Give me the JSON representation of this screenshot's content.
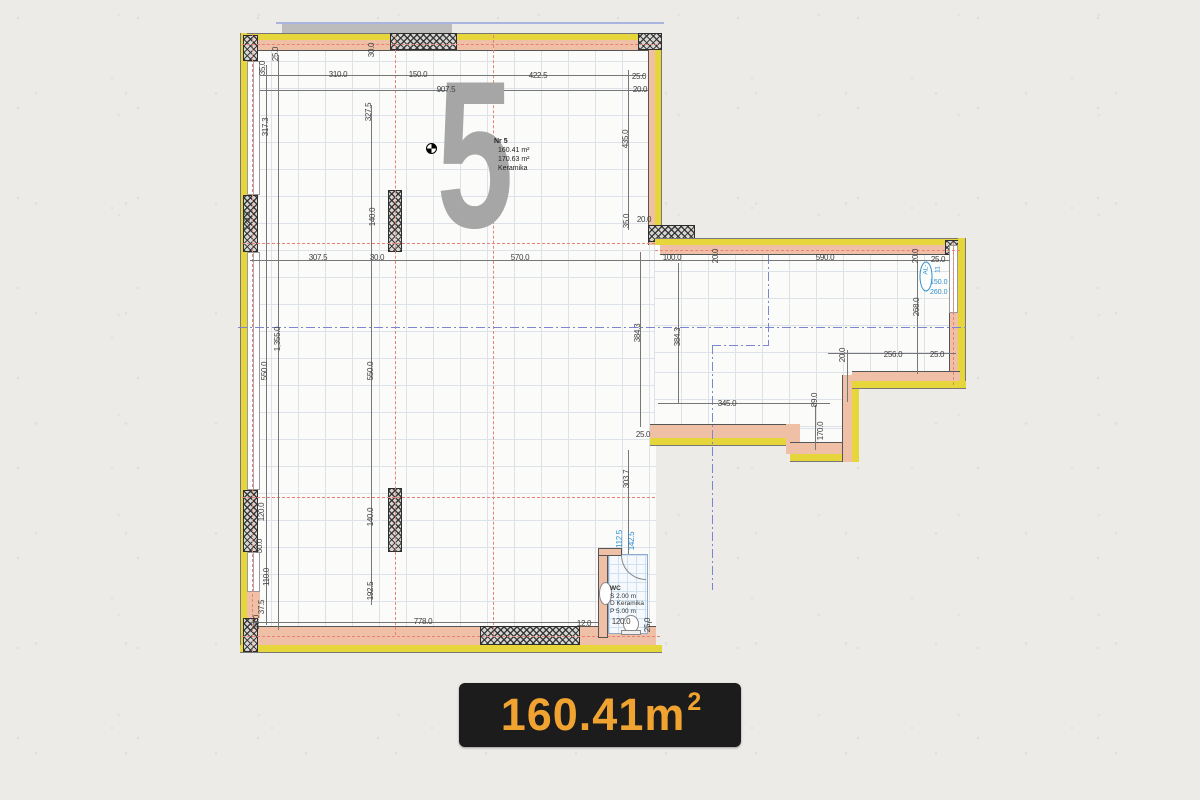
{
  "badge": {
    "value": "160.41m",
    "sup": "2"
  },
  "watermark": {
    "digit": "5"
  },
  "unit_info": {
    "line1": "Nr 5",
    "line2": "160.41 m²",
    "line3": "170.63 m²",
    "line4": "Keramika"
  },
  "wc": {
    "title": "WC",
    "line1": "S 2.00 m",
    "line2": "D Keramika",
    "line3": "P 5.00 m"
  },
  "window_tag": {
    "label": "AL-11",
    "width": "150.0",
    "height": "260.0"
  },
  "colors": {
    "paper": "#edebe8",
    "wall_yellow": "#e7d63b",
    "wall_fill": "#efc0a6",
    "axis_red": "#e88276",
    "axis_blue": "#7b85d2",
    "grid": "#dde2e8",
    "badge_bg": "#1c1c1c",
    "badge_text": "#f0a330",
    "dim_text": "#3f3f3f",
    "watermark": "#a6a6a6",
    "tag_blue": "#2f8fd0"
  },
  "dimensions": [
    {
      "t": "310.0",
      "x": 108,
      "y": 55
    },
    {
      "t": "150.0",
      "x": 188,
      "y": 55
    },
    {
      "t": "422.5",
      "x": 308,
      "y": 56
    },
    {
      "t": "25.0",
      "x": 409,
      "y": 57
    },
    {
      "t": "907.5",
      "x": 216,
      "y": 70
    },
    {
      "t": "20.0",
      "x": 410,
      "y": 70
    },
    {
      "t": "35.0",
      "x": 33,
      "y": 48,
      "r": 1
    },
    {
      "t": "25.0",
      "x": 46,
      "y": 34,
      "r": 1
    },
    {
      "t": "30.0",
      "x": 142,
      "y": 30,
      "r": 1
    },
    {
      "t": "317.3",
      "x": 36,
      "y": 107,
      "r": 1
    },
    {
      "t": "327.5",
      "x": 139,
      "y": 92,
      "r": 1
    },
    {
      "t": "435.0",
      "x": 396,
      "y": 119,
      "r": 1
    },
    {
      "t": "120.3",
      "x": 18,
      "y": 201,
      "r": 1
    },
    {
      "t": "140.0",
      "x": 143,
      "y": 197,
      "r": 1
    },
    {
      "t": "35.0",
      "x": 397,
      "y": 201,
      "r": 1
    },
    {
      "t": "20.0",
      "x": 414,
      "y": 200
    },
    {
      "t": "307.5",
      "x": 88,
      "y": 238
    },
    {
      "t": "30.0",
      "x": 147,
      "y": 238
    },
    {
      "t": "570.0",
      "x": 290,
      "y": 238
    },
    {
      "t": "100.0",
      "x": 442,
      "y": 238
    },
    {
      "t": "20.0",
      "x": 486,
      "y": 236,
      "r": 1
    },
    {
      "t": "590.0",
      "x": 595,
      "y": 238
    },
    {
      "t": "20.0",
      "x": 686,
      "y": 236,
      "r": 1
    },
    {
      "t": "25.0",
      "x": 708,
      "y": 240
    },
    {
      "t": "550.0",
      "x": 35,
      "y": 351,
      "r": 1
    },
    {
      "t": "1,355.0",
      "x": 48,
      "y": 319,
      "r": 1
    },
    {
      "t": "550.0",
      "x": 141,
      "y": 351,
      "r": 1
    },
    {
      "t": "384.3",
      "x": 408,
      "y": 313,
      "r": 1
    },
    {
      "t": "384.3",
      "x": 448,
      "y": 317,
      "r": 1
    },
    {
      "t": "268.0",
      "x": 687,
      "y": 287,
      "r": 1
    },
    {
      "t": "345.0",
      "x": 497,
      "y": 384
    },
    {
      "t": "89.0",
      "x": 585,
      "y": 380,
      "r": 1
    },
    {
      "t": "170.0",
      "x": 591,
      "y": 411,
      "r": 1
    },
    {
      "t": "20.0",
      "x": 613,
      "y": 335,
      "r": 1
    },
    {
      "t": "256.0",
      "x": 663,
      "y": 335
    },
    {
      "t": "25.0",
      "x": 707,
      "y": 335
    },
    {
      "t": "25.0",
      "x": 413,
      "y": 415
    },
    {
      "t": "120.0",
      "x": 32,
      "y": 492,
      "r": 1
    },
    {
      "t": "30.0",
      "x": 30,
      "y": 526,
      "r": 1
    },
    {
      "t": "110.0",
      "x": 37,
      "y": 557,
      "r": 1
    },
    {
      "t": "37.5",
      "x": 32,
      "y": 587,
      "r": 1
    },
    {
      "t": "25.0",
      "x": 27,
      "y": 602,
      "r": 1
    },
    {
      "t": "192.5",
      "x": 141,
      "y": 571,
      "r": 1
    },
    {
      "t": "140.0",
      "x": 141,
      "y": 497,
      "r": 1
    },
    {
      "t": "303.7",
      "x": 397,
      "y": 459,
      "r": 1
    },
    {
      "t": "778.0",
      "x": 193,
      "y": 602
    },
    {
      "t": "12.0",
      "x": 354,
      "y": 604
    },
    {
      "t": "120.0",
      "x": 391,
      "y": 602
    },
    {
      "t": "25.0",
      "x": 418,
      "y": 605,
      "r": 1
    },
    {
      "t": "112.5",
      "x": 390,
      "y": 519,
      "r": 1,
      "c": 1
    },
    {
      "t": "142.5",
      "x": 402,
      "y": 521,
      "r": 1,
      "c": 1
    }
  ]
}
